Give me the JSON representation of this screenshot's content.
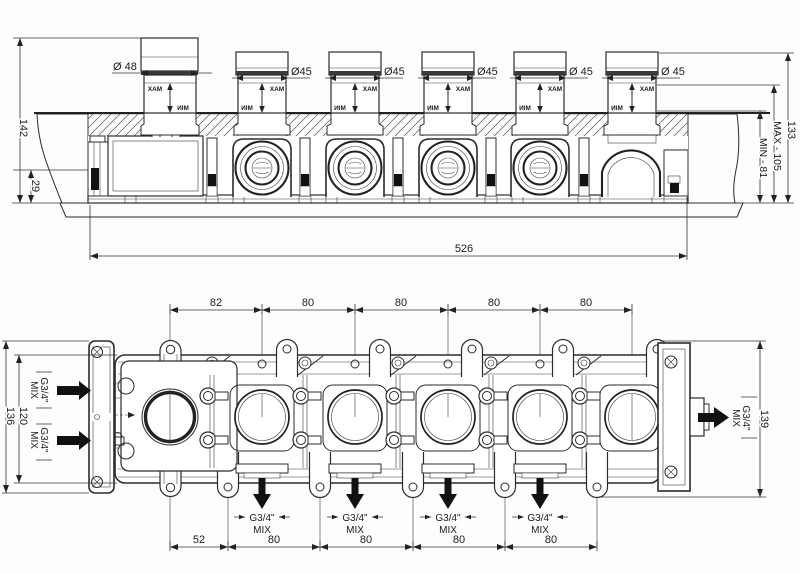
{
  "top_view": {
    "knob1_dia": "Ø 48",
    "knob_dias": [
      "Ø45",
      "Ø45",
      "Ø45",
      "Ø 45",
      "Ø 45"
    ],
    "max_label": "MAX",
    "min_label": "MIN",
    "dim_height": "142",
    "dim_base": "29",
    "dim_total_depth": "133",
    "dim_max_depth": "MAX - 105",
    "dim_min_depth": "MIN - 81",
    "dim_width": "526"
  },
  "bottom_view": {
    "top_dims": [
      "82",
      "80",
      "80",
      "80",
      "80"
    ],
    "bottom_dims": [
      "52",
      "80",
      "80",
      "80",
      "80"
    ],
    "dim_left_outer": "136",
    "dim_left_inner": "120",
    "dim_right": "139",
    "port_size": "G3/4\"",
    "port_type": "MIX"
  }
}
